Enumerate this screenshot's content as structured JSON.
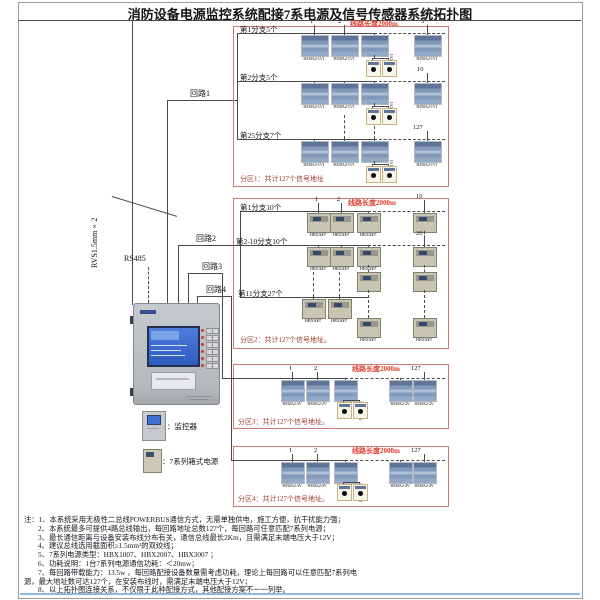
{
  "title": "消防设备电源监控系统配接7系电源及信号传感器系统拓扑图",
  "wiring": {
    "riser_label": "RVS1.5mm×2",
    "rs485_label": "RS485",
    "loop_labels": [
      "回路1",
      "回路2",
      "回路3",
      "回路4"
    ]
  },
  "controller": {
    "legend_monitor": "：监控器",
    "legend_power": "：7系列箱式电源"
  },
  "zones": [
    {
      "line_length": "线路长度2000m",
      "device_label": "HJ30A2-1V1",
      "branch_labels": [
        "第1分支5个",
        "第2分支5个",
        "第25分支7个"
      ],
      "numbers": [
        "1",
        "2",
        "5",
        "10",
        "127"
      ],
      "footer": "分区1：共计127个信号地址"
    },
    {
      "line_length": "线路长度2000m",
      "device_label": "HBX3007",
      "branch_labels": [
        "第1分支10个",
        "第2-10分支10个",
        "第11分支27个"
      ],
      "numbers": [
        "1",
        "2",
        "10",
        "20"
      ],
      "footer": "分区2：共计127个信号地址。"
    },
    {
      "line_length": "线路长度2000m",
      "device_label": "HJ30A2-2V",
      "branch_labels": [],
      "numbers": [
        "1",
        "2",
        "127"
      ],
      "footer": "分区3：共计127个信号地址。"
    },
    {
      "line_length": "线路长度2000m",
      "device_label": "HJ30A2-4V",
      "branch_labels": [],
      "numbers": [
        "1",
        "2",
        "127"
      ],
      "footer": "分区4：共计127个信号地址。"
    }
  ],
  "notes": [
    "注：1、本系统采用无极性二总线POWERBUS通信方式，无需单独供电，施工方便，抗干扰能力强；",
    "2、本系统最多可提供4路总线输出，每回路地址总数127个，每回路可任意匹配7系列电源；",
    "3、最长通信距离与设备安装布线分布有关，通信总线最长2Km，且需满足末端电压大于12V；",
    "4、建议总线选用截面积≥1.5mm²的双绞线；",
    "5、7系列电源类型：HBX1007、HBX2007、HBX3007 ；",
    "6、功耗说明：1台7系列电源通信功耗：＜20mw；",
    "7、每回路带载能力：13.5w ，每回路配接设备数量需考虑功耗，理论上每回路可以任意匹配7系列电",
    "源，最大地址数可达127个，在安装布线时，需满足末端电压大于12V；",
    "8、以上拓扑图连接关系，不仅限于此种配接方式，其他配接方案不一一列举。"
  ]
}
